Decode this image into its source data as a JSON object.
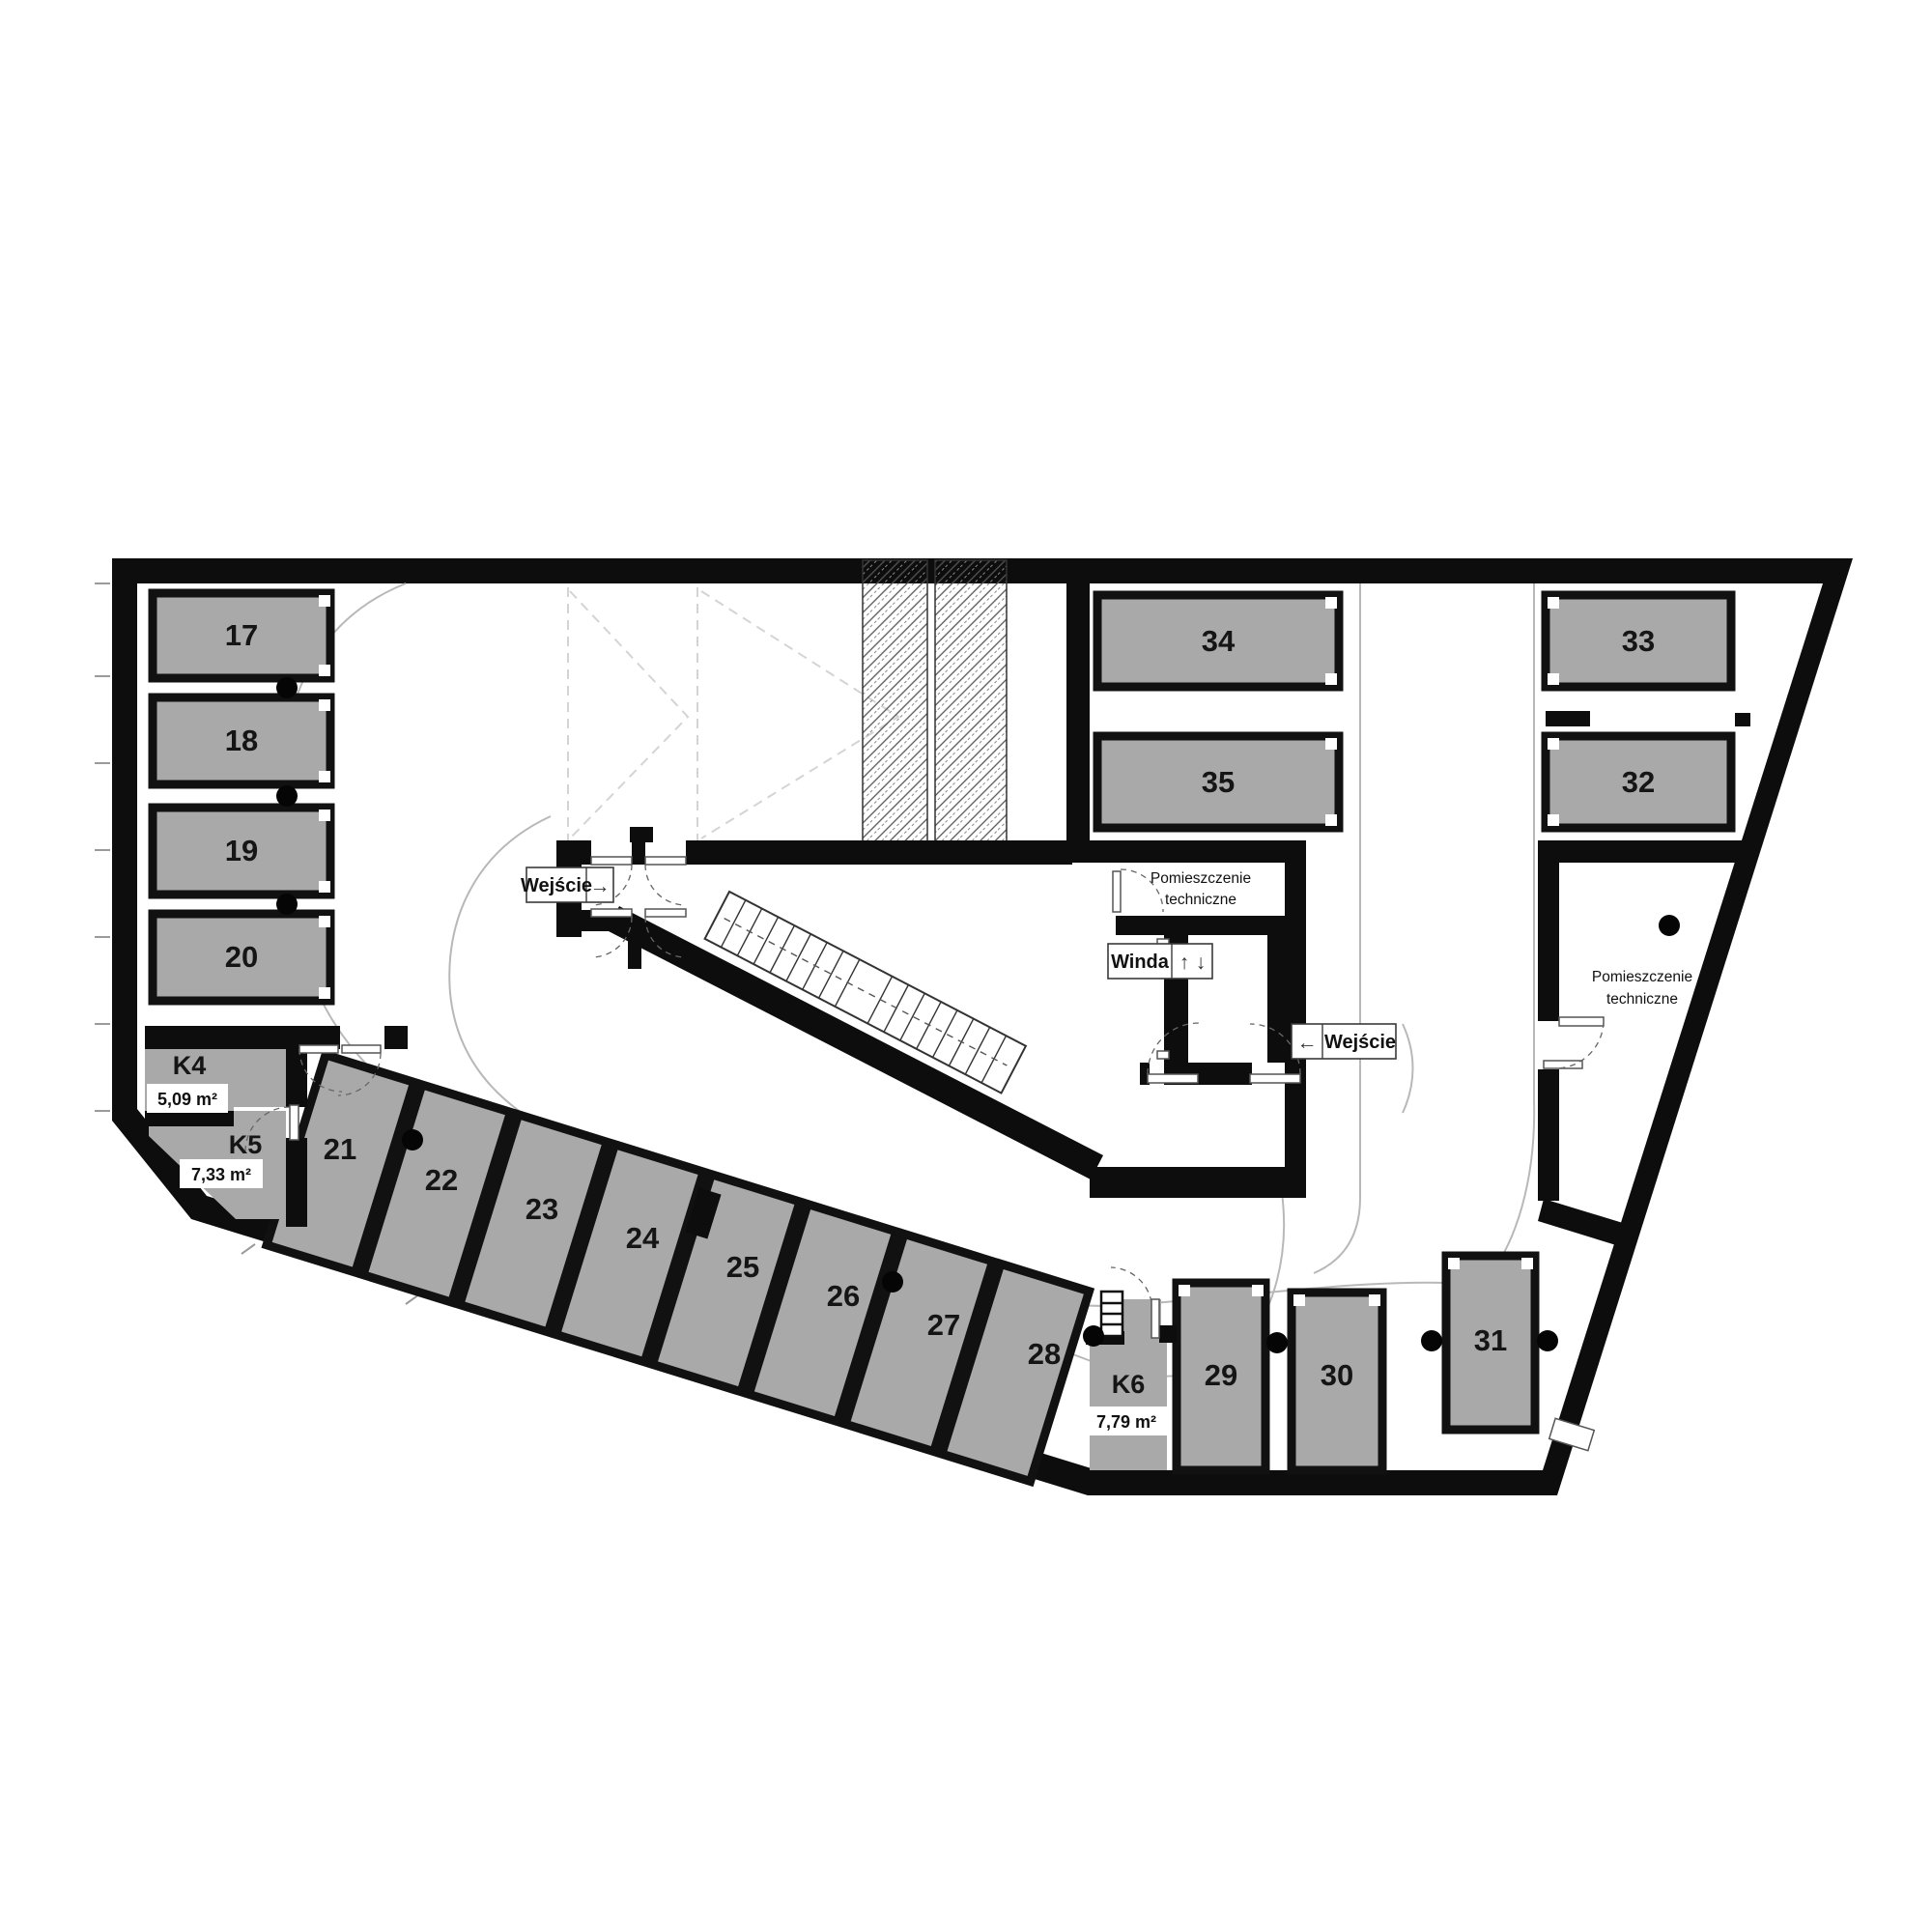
{
  "plan": {
    "spots": [
      {
        "label": "17"
      },
      {
        "label": "18"
      },
      {
        "label": "19"
      },
      {
        "label": "20"
      },
      {
        "label": "21"
      },
      {
        "label": "22"
      },
      {
        "label": "23"
      },
      {
        "label": "24"
      },
      {
        "label": "25"
      },
      {
        "label": "26"
      },
      {
        "label": "27"
      },
      {
        "label": "28"
      },
      {
        "label": "29"
      },
      {
        "label": "30"
      },
      {
        "label": "31"
      },
      {
        "label": "32"
      },
      {
        "label": "33"
      },
      {
        "label": "34"
      },
      {
        "label": "35"
      }
    ],
    "storage": [
      {
        "label": "K4",
        "area": "5,09 m²"
      },
      {
        "label": "K5",
        "area": "7,33 m²"
      },
      {
        "label": "K6",
        "area": "7,79 m²"
      }
    ],
    "labels": {
      "entrance": "Wejście",
      "elevator": "Winda",
      "tech1": "Pomieszczenie",
      "tech2": "techniczne",
      "arrow_right": "→",
      "arrow_left": "←",
      "arrow_up": "↑",
      "arrow_down": "↓"
    },
    "colors": {
      "highlight": "#c9a06a",
      "stall": "#a9a9a9",
      "wall": "#0d0d0d"
    }
  }
}
